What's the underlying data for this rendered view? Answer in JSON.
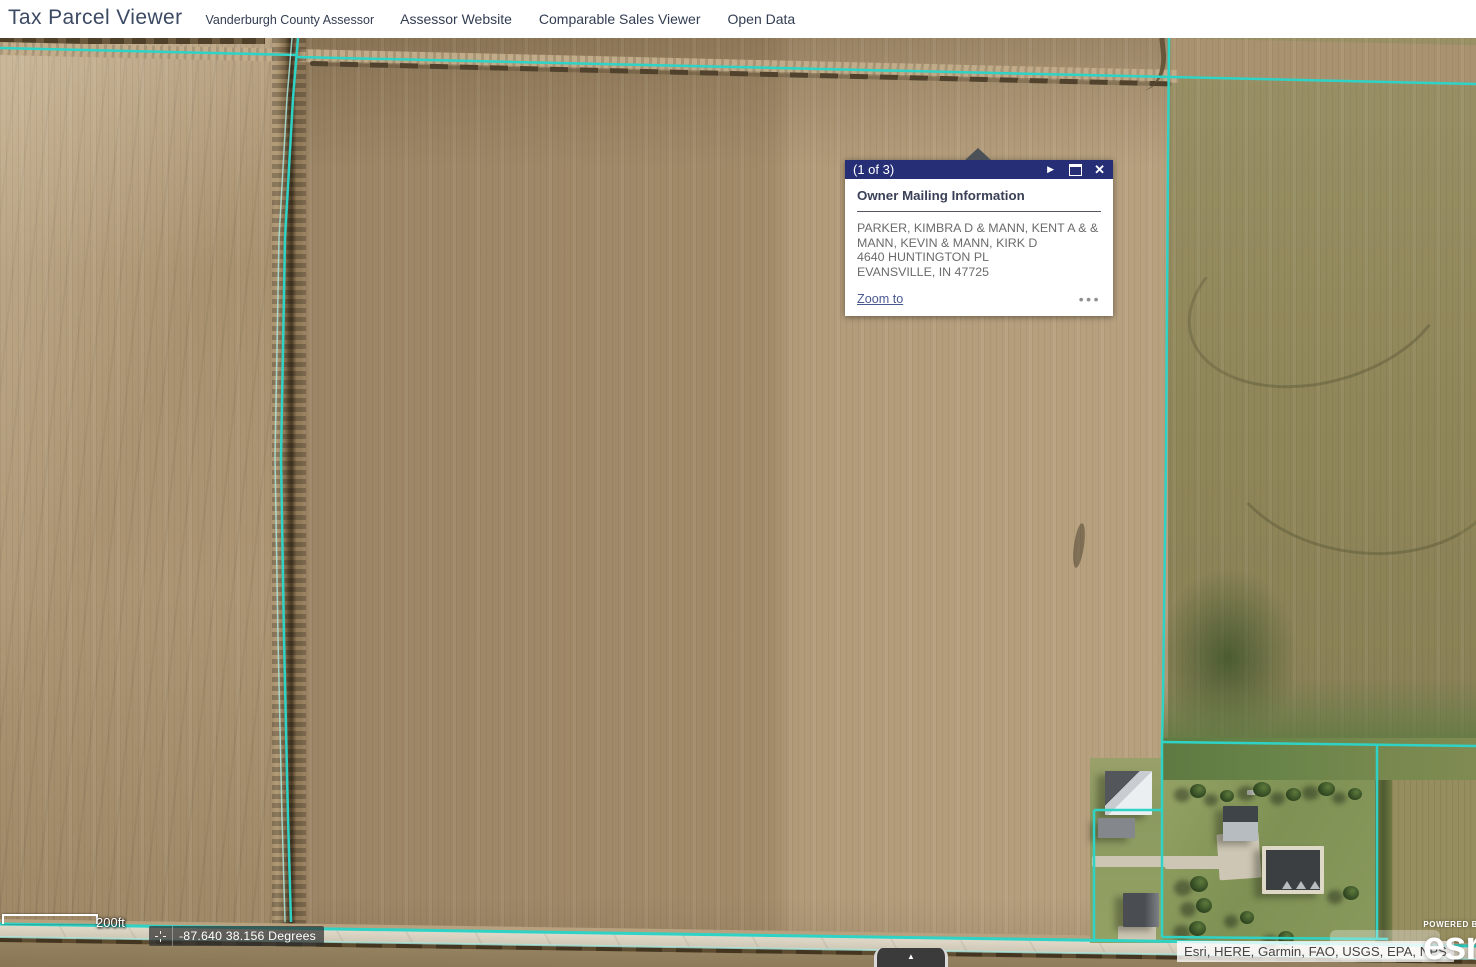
{
  "app": {
    "title": "Tax Parcel Viewer",
    "subtitle": "Vanderburgh County Assessor",
    "links": [
      {
        "label": "Assessor Website"
      },
      {
        "label": "Comparable Sales Viewer"
      },
      {
        "label": "Open Data"
      }
    ]
  },
  "popup": {
    "pager": "(1 of 3)",
    "next_icon": "▶",
    "close_icon": "✕",
    "title": "Owner Mailing Information",
    "owner_lines": [
      "PARKER, KIMBRA D & MANN, KENT A & &",
      "MANN, KEVIN & MANN, KIRK D",
      "4640 HUNTINGTON PL",
      "EVANSVILLE, IN 47725"
    ],
    "zoom_to_label": "Zoom to",
    "menu_icon": "•••",
    "header_color": "#262e76"
  },
  "map": {
    "parcel_line_color": "#2fd3c6",
    "parcel_line_secondary": "#a9e6dd",
    "scale_label": "200ft",
    "coordinates": "-87.640 38.156 Degrees",
    "attribution": "Esri, HERE, Garmin, FAO, USGS, EPA, NPS",
    "powered_by": "POWERED BY",
    "logo_text": "esri",
    "expand_icon": "▲"
  }
}
